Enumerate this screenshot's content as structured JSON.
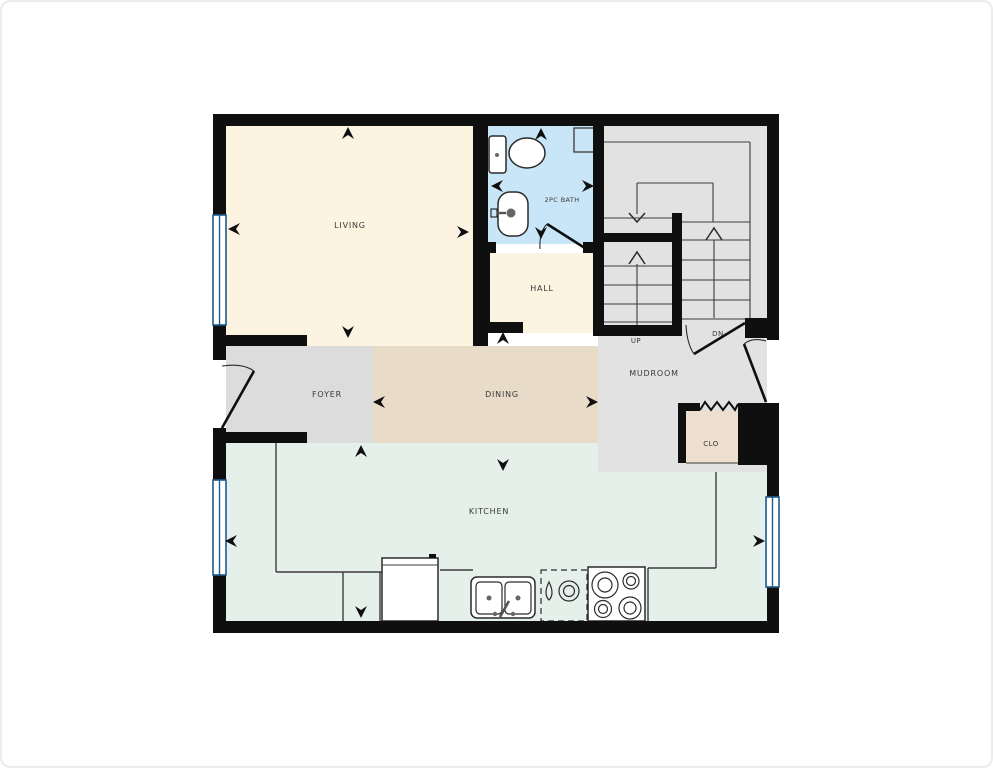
{
  "plan": {
    "rooms": {
      "living": {
        "label": "LIVING"
      },
      "bath": {
        "label": "2PC BATH"
      },
      "hall": {
        "label": "HALL"
      },
      "foyer": {
        "label": "FOYER"
      },
      "dining": {
        "label": "DINING"
      },
      "mudroom": {
        "label": "MUDROOM"
      },
      "closet": {
        "label": "CLO"
      },
      "kitchen": {
        "label": "KITCHEN"
      }
    },
    "stairs": {
      "up_label": "UP",
      "down_label": "DN"
    }
  },
  "colors": {
    "wall": "#0f0f0f",
    "living": "#fcf4e0",
    "bath": "#c9e6f8",
    "hall": "#fcf4e0",
    "foyer": "#dcdcdc",
    "dining": "#e8dcc8",
    "mudroom": "#e2e2e2",
    "stairs": "#e2e2e2",
    "closet": "#eddfd0",
    "kitchen": "#e4f0e9",
    "window_fill": "#58a5da",
    "window_line": "#1d5c8f",
    "line": "#3c3c3c",
    "background": "#ffffff"
  }
}
